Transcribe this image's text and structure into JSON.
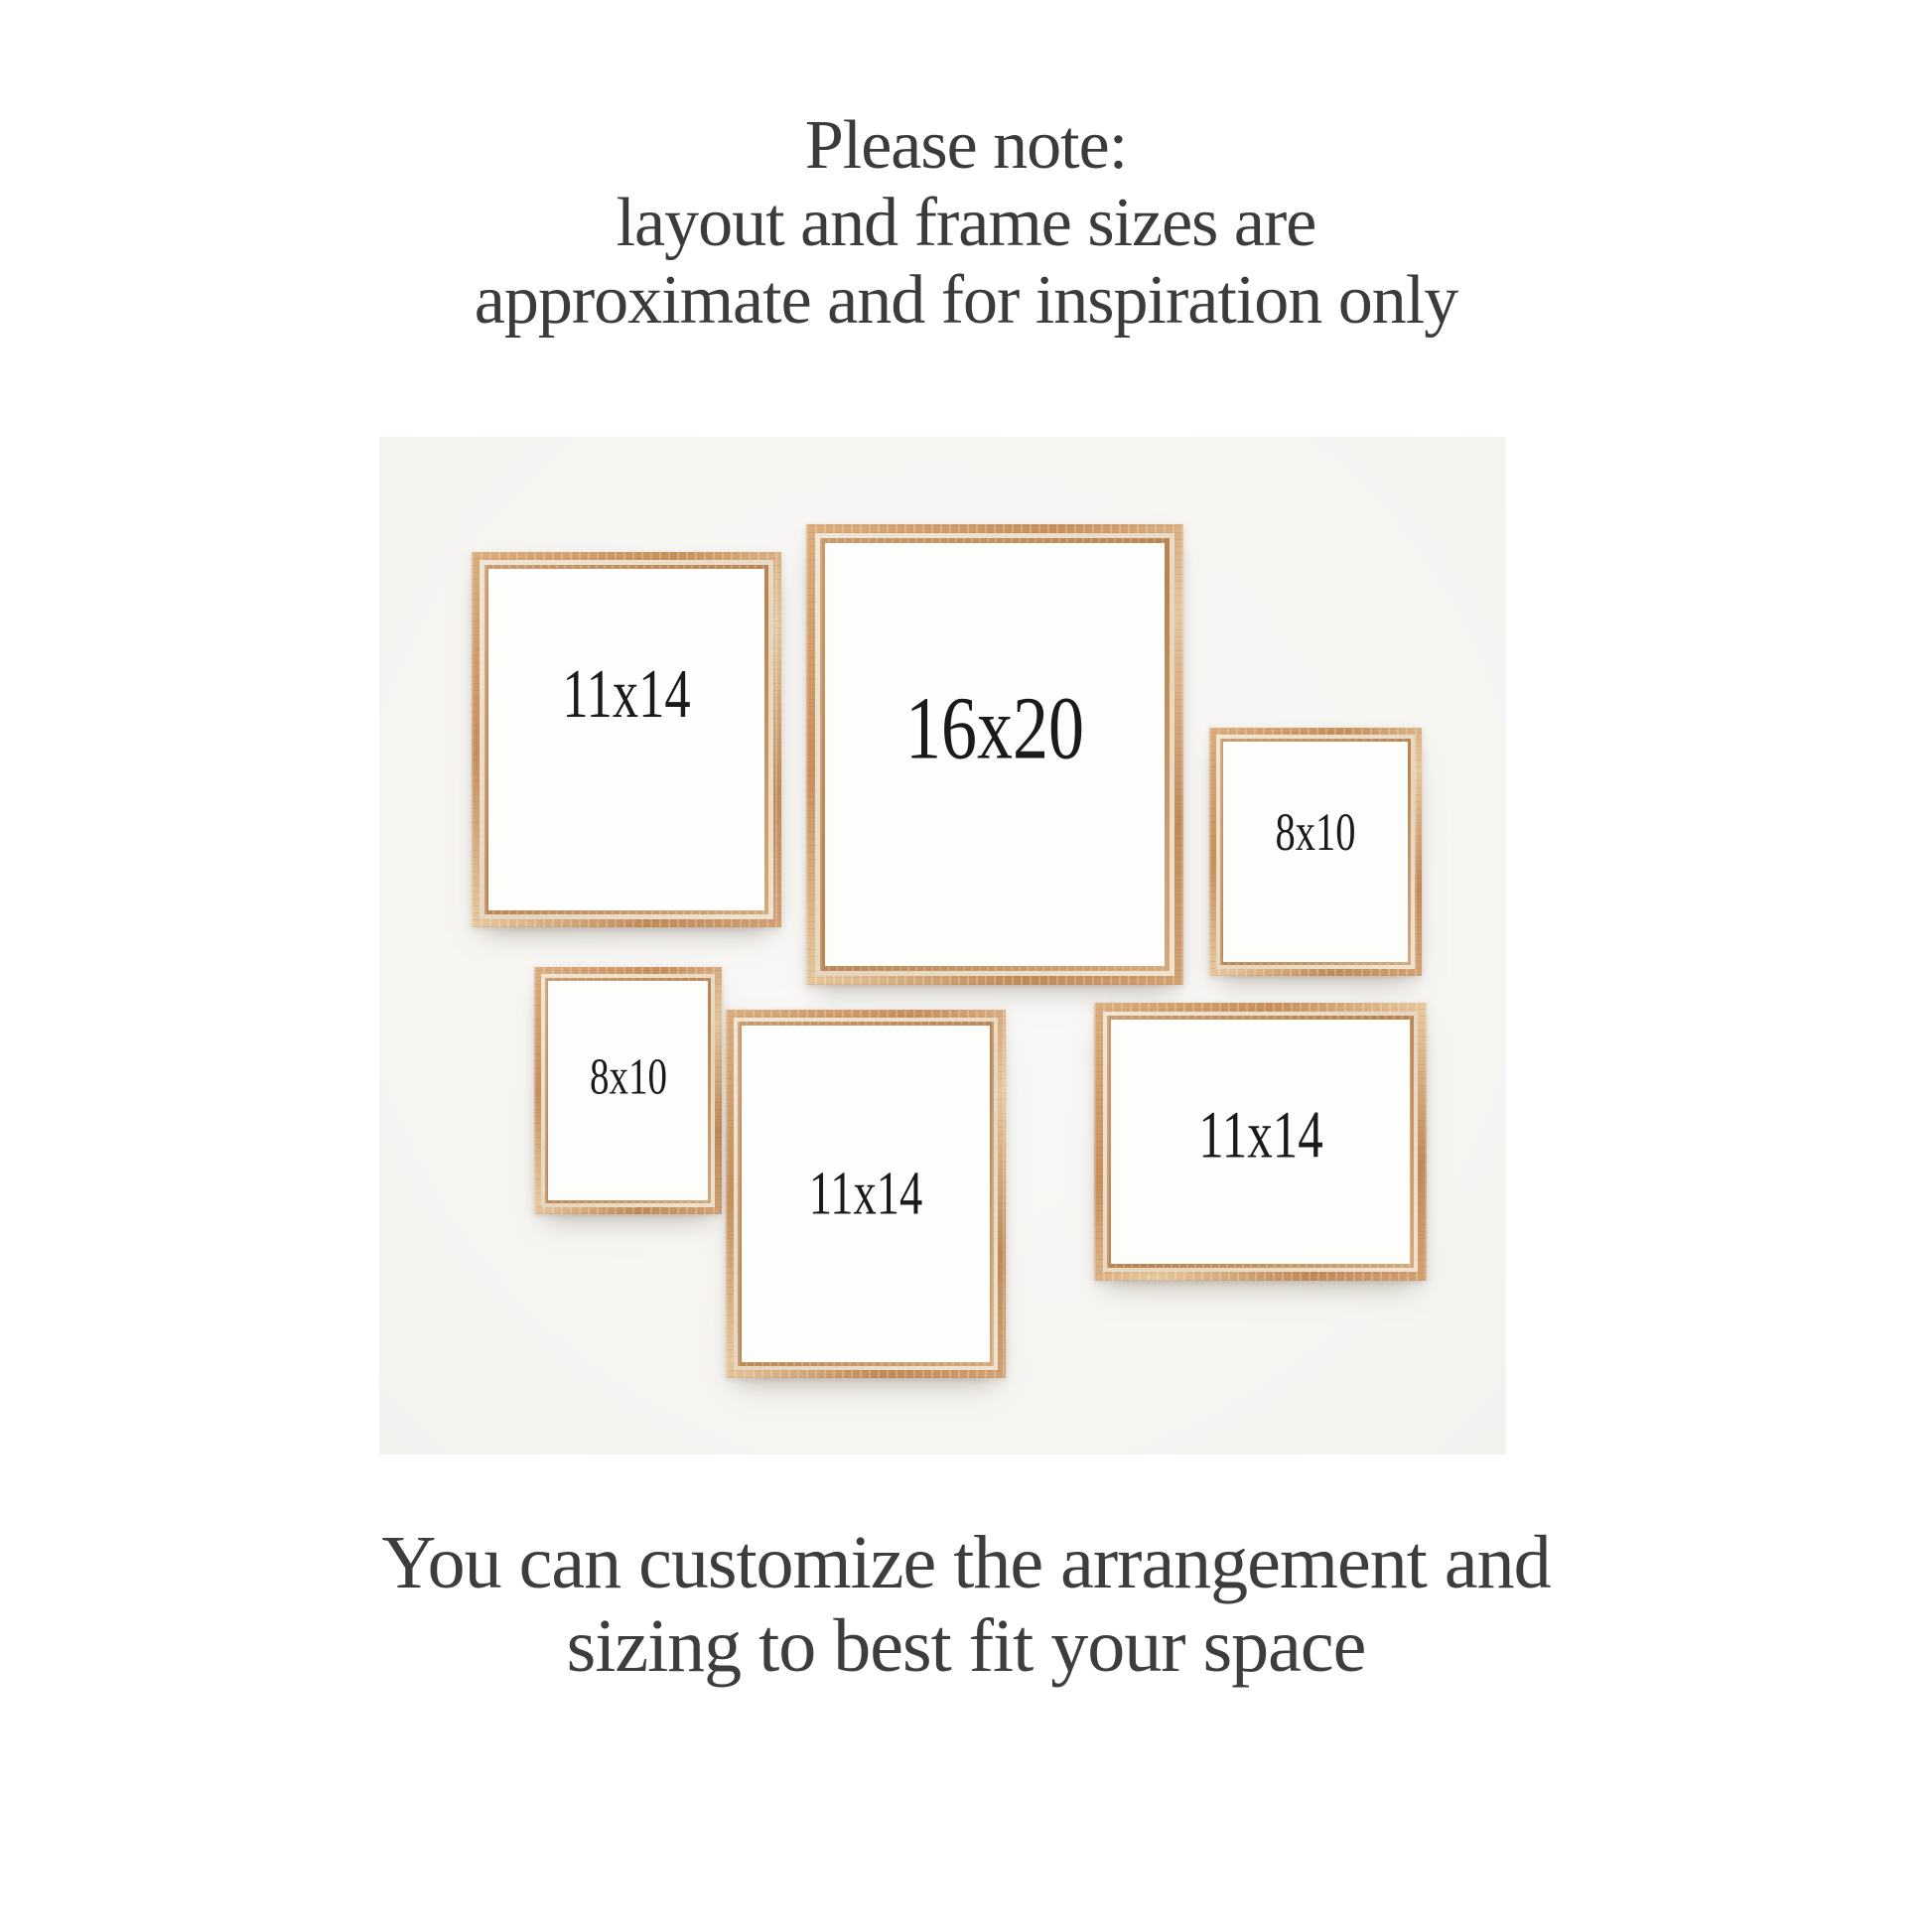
{
  "note": {
    "lines": [
      "Please note:",
      "layout and frame sizes are",
      "approximate and for inspiration only"
    ]
  },
  "footer": {
    "lines": [
      "You can customize the arrangement and",
      "sizing to best fit your space"
    ]
  },
  "wall": {
    "description": "light wall mockup with six whitewashed natural wood frames",
    "background_color": "#f6f5f2"
  },
  "colors": {
    "page_background": "#ffffff",
    "wood_mid": "#c68f5c",
    "wood_highlight": "#e7c79d",
    "wood_whitewash": "#e6d6bf",
    "heading_text": "#3b3b3d",
    "label_text": "#1a1a1a",
    "frame_interior": "#fdfdfc"
  },
  "frames": [
    {
      "label": "11x14",
      "orientation": "portrait",
      "position": "top-left"
    },
    {
      "label": "16x20",
      "orientation": "portrait",
      "position": "top-center"
    },
    {
      "label": "8x10",
      "orientation": "portrait",
      "position": "middle-right"
    },
    {
      "label": "8x10",
      "orientation": "portrait",
      "position": "bottom-left"
    },
    {
      "label": "11x14",
      "orientation": "portrait",
      "position": "bottom-center"
    },
    {
      "label": "11x14",
      "orientation": "landscape",
      "position": "bottom-right"
    }
  ]
}
